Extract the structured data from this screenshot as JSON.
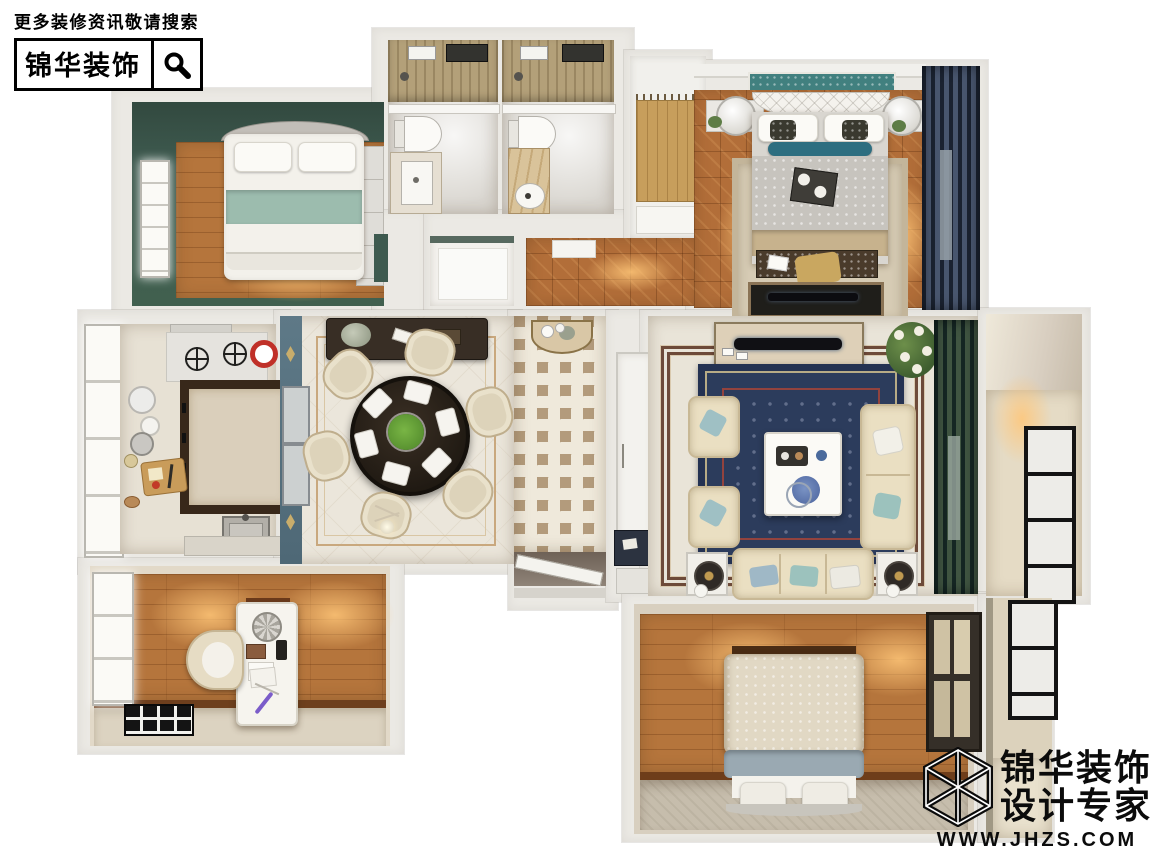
{
  "header": {
    "tagline": "更多装修资讯敬请搜索",
    "brand": "锦华装饰",
    "search_icon": "magnifier"
  },
  "brand_logo": {
    "name": "锦华装饰",
    "subtitle": "设计专家",
    "website": "WWW.JHZS.COM",
    "mark_icon": "wireframe-cube"
  },
  "scene": {
    "kind": "3d-top-down-floorplan-render",
    "rooms": [
      "green-bedroom",
      "bathroom-1",
      "bathroom-2",
      "walk-in-closet",
      "master-bedroom",
      "hall-corridor",
      "pantry",
      "kitchen",
      "dining-room",
      "entry-foyer",
      "living-room",
      "east-balcony",
      "study",
      "south-bedroom",
      "southeast-balcony"
    ]
  },
  "palette": {
    "wall": "#ebe9e4",
    "wood_floor": "#b5753c",
    "parquet": "#b26e39",
    "green_wall": "#3e5a4f",
    "marble": "#dad7d1",
    "foyer_tile_tan": "#b39b7c",
    "rug_navy": "#2c3c5c",
    "curtain_teal": "#24423c",
    "curtain_navy": "#2b3850",
    "sage_blanket": "#9cbcae",
    "cream_sofa": "#eadfc2",
    "teal_wallpaper": "#41807f"
  }
}
